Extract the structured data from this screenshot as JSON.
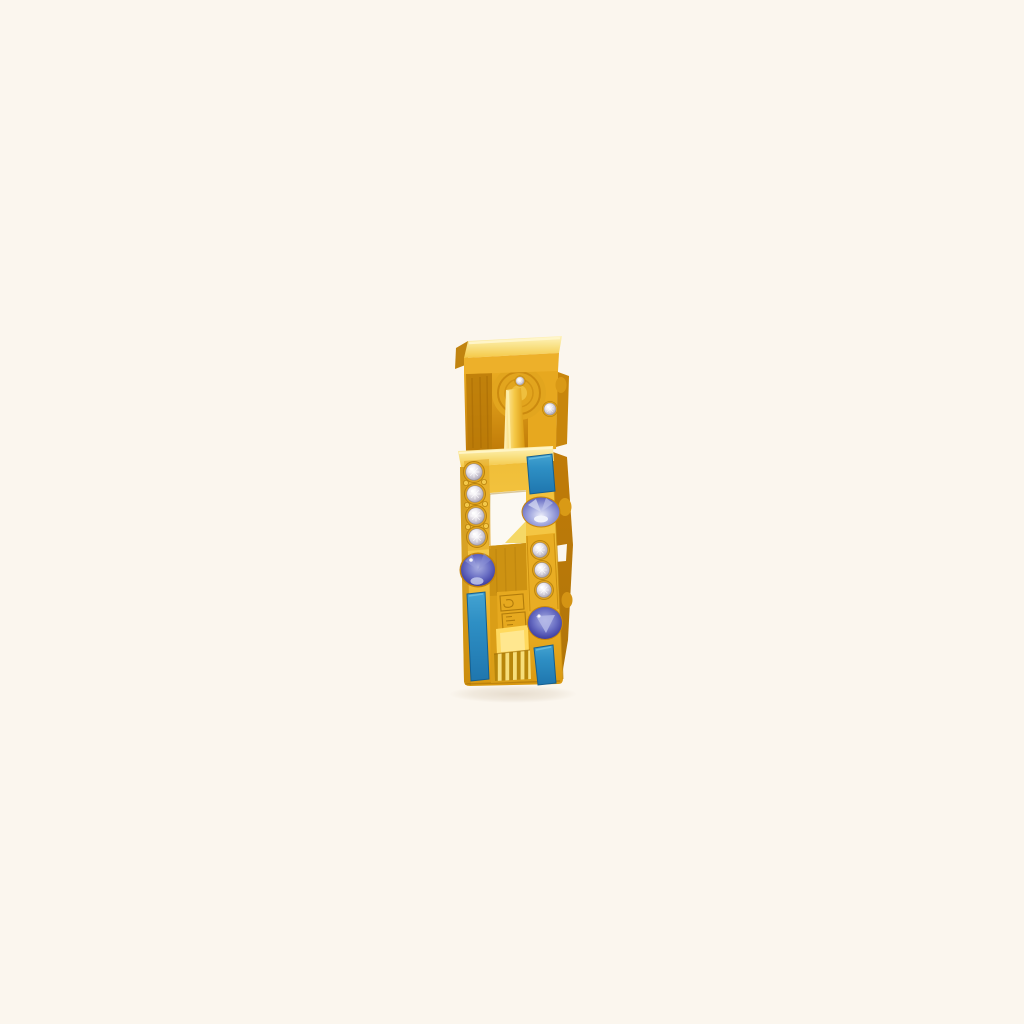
{
  "scene": {
    "type": "product-photo",
    "background_color": "#FBF6EE",
    "description": "Yellow-gold square huggie hoop earring with blue enamel inlays, round blue sapphires and pave-set white stones, standing upright on a plain cream background"
  },
  "earring": {
    "metal": {
      "gold_highlight": "#FFF3BE",
      "gold_bright": "#F9E288",
      "gold_light": "#F5C846",
      "gold_mid": "#F0BE38",
      "gold_amber": "#EAAC22",
      "gold_deep": "#D99810",
      "gold_bronze": "#C07B08",
      "gold_dark": "#B0750A"
    },
    "enamel": {
      "light": "#44A3D2",
      "base": "#2E8FC4",
      "dark": "#1F76AE",
      "outline": "#155F90",
      "segments_visible": 3
    },
    "sapphires": {
      "pale": "#E9EBF9",
      "light": "#A9AFE2",
      "mid": "#6A6FC4",
      "deep": "#3D3DA0",
      "edge": "#26267C",
      "count_visible": 3
    },
    "diamonds": {
      "sparkle": "#FFFFFF",
      "light": "#EDEAF0",
      "base": "#C6C1CD",
      "shade": "#948E9D",
      "left_column_count": 4,
      "right_column_count": 3,
      "hinge_count": 2
    },
    "hallmark": {
      "stamp_color": "#A87408",
      "rib_dark": "#B8860B",
      "rib_light": "#F7DE7A"
    }
  }
}
